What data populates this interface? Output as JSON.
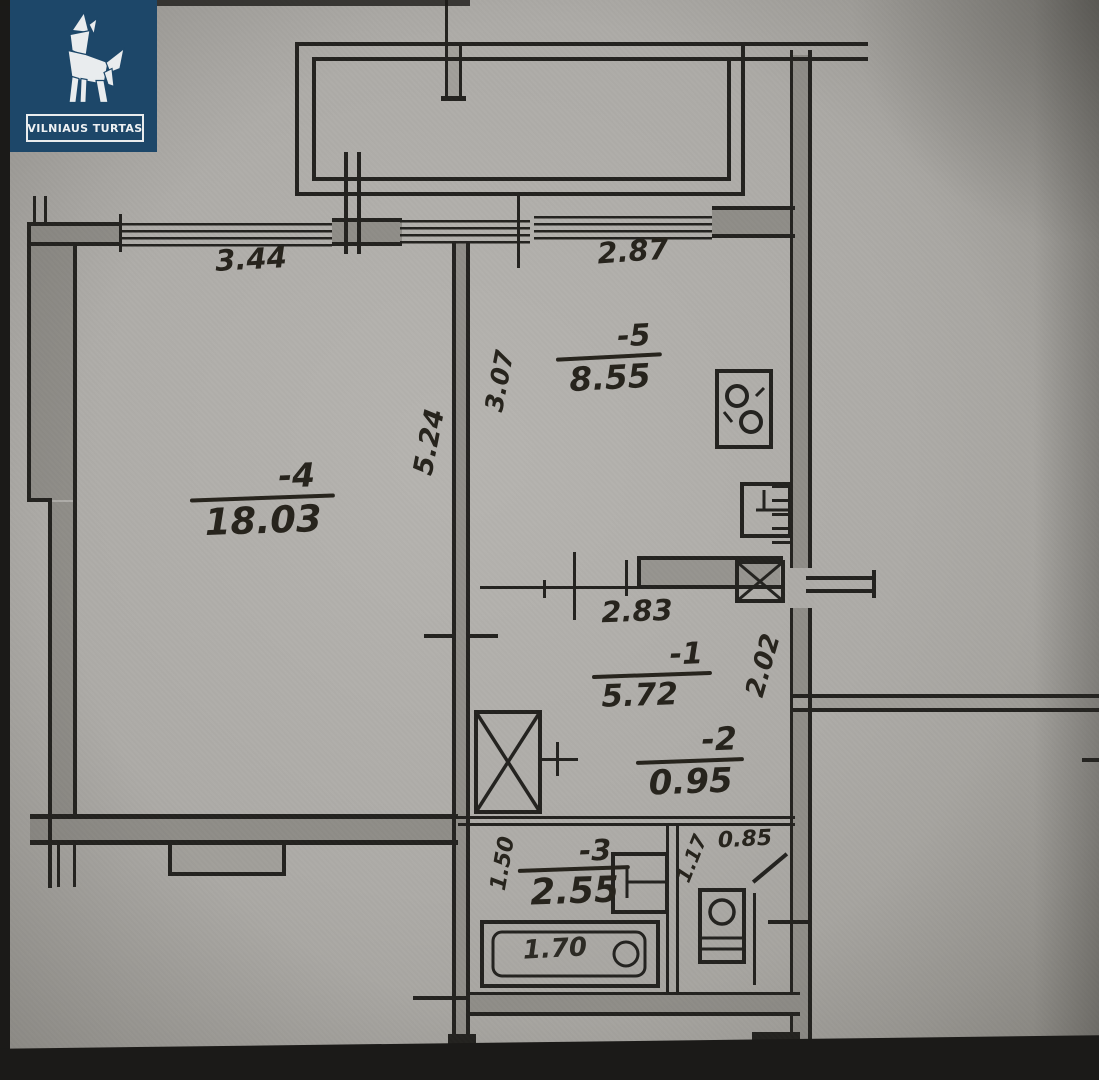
{
  "brand": {
    "name": "VILNIAUS TURTAS",
    "bg_color": "#1d4769",
    "fg_color": "#eef1f3",
    "logo_icon": "origami-wolf"
  },
  "plan": {
    "type": "apartment-floor-plan",
    "rooms": {
      "room4": {
        "num": "-4",
        "area": "18.03"
      },
      "room5": {
        "num": "-5",
        "area": "8.55"
      },
      "room1": {
        "num": "-1",
        "area": "5.72"
      },
      "room2": {
        "num": "-2",
        "area": "0.95"
      },
      "room3": {
        "num": "-3",
        "area": "2.55"
      }
    },
    "dims": {
      "window_left": "3.44",
      "window_right": "2.87",
      "room4_depth": "5.24",
      "room5_depth": "3.07",
      "hall_width": "2.83",
      "hall_depth": "2.02",
      "wc_width": "0.85",
      "bath_depth": "1.50",
      "wc_depth": "1.17",
      "bathtub_length": "1.70"
    },
    "fixtures": [
      "stove",
      "kitchen-sink",
      "flue-shaft",
      "closet",
      "washbasin",
      "toilet",
      "bathtub"
    ],
    "colors": {
      "paper": "#adaba7",
      "ink": "#23221f",
      "wall_fill": "#8f8d88"
    }
  }
}
